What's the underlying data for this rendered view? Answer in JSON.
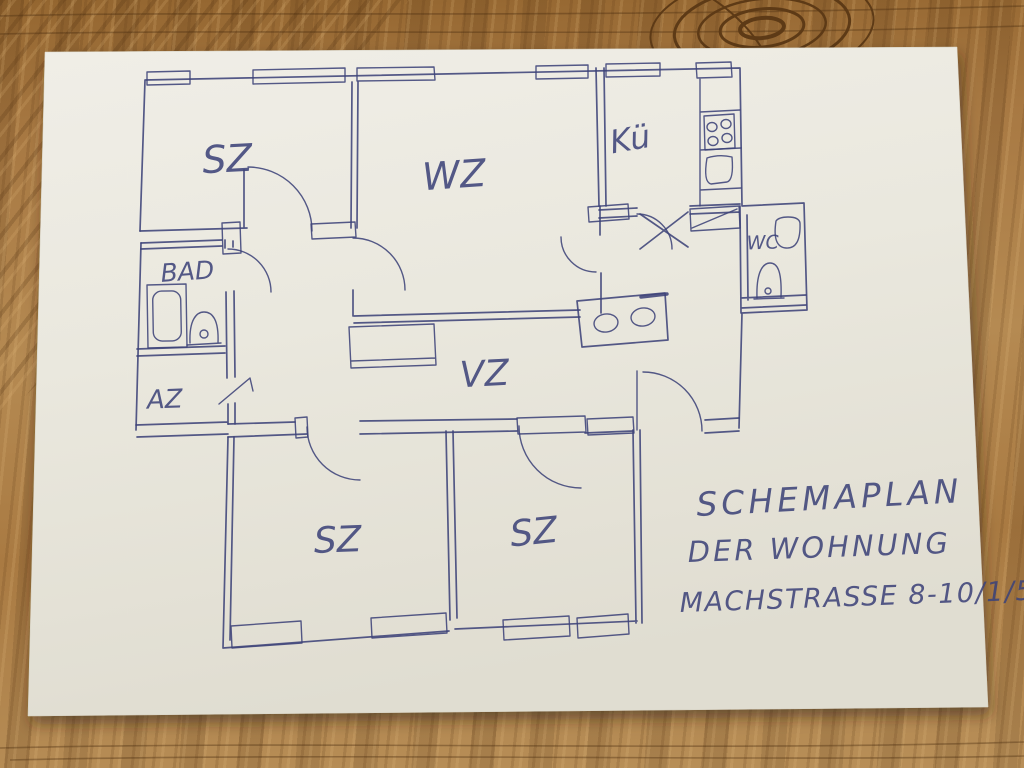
{
  "photo": {
    "description": "Hand-drawn apartment floor plan sketch in blue ballpoint pen on a white sheet of paper lying on an oak wood table",
    "ink_color": "#3d4379",
    "paper_color": "#eae7dd",
    "wood_color": "#a87943"
  },
  "annotation": {
    "line1": "SCHEMAPLAN",
    "line2": "DER WOHNUNG",
    "line3": "MACHSTRASSE 8-10/1/5"
  },
  "rooms": [
    {
      "id": "sz-top-left",
      "label": "SZ"
    },
    {
      "id": "wz",
      "label": "WZ"
    },
    {
      "id": "kueche",
      "label": "Kü"
    },
    {
      "id": "bad",
      "label": "BAD"
    },
    {
      "id": "az",
      "label": "AZ"
    },
    {
      "id": "wc",
      "label": "WC"
    },
    {
      "id": "vz",
      "label": "VZ"
    },
    {
      "id": "sz-bottom-left",
      "label": "SZ"
    },
    {
      "id": "sz-bottom-right",
      "label": "SZ"
    }
  ],
  "fixtures": [
    "stove-four-burners",
    "kitchen-sink",
    "tall-cabinet",
    "bathtub",
    "bathroom-sink",
    "toilet",
    "toilet-tank",
    "hall-cabinet-two-basins",
    "wardrobe-closet"
  ]
}
